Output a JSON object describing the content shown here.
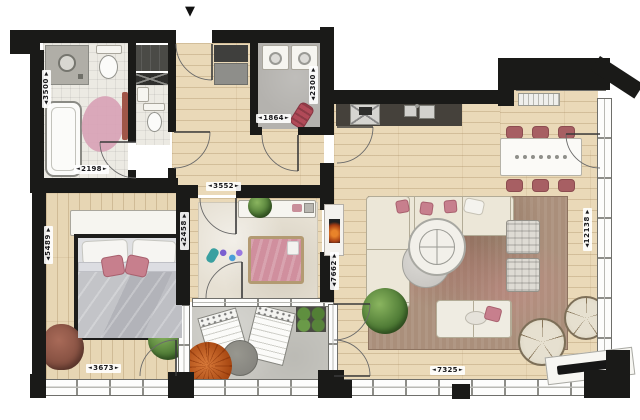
{
  "arrows": {
    "left": "◄",
    "right": "►",
    "up": "▲",
    "down": "▼",
    "entrance": "▼"
  },
  "dimensions": {
    "bathroom_height": "3500",
    "bathroom_width": "2198",
    "storage_width": "1864",
    "storage_height": "2300",
    "nursery_width": "3552",
    "nursery_height": "2458",
    "bedroom_height": "5489",
    "bedroom_width": "3673",
    "living_height": "7662",
    "living_width": "7325",
    "apartment_height": "12138"
  },
  "colors": {
    "wall": "#1a1a18",
    "wood_floor": "#ead9b8",
    "tile_floor": "#eceae3",
    "storage_floor": "#b4b2ae",
    "balcony_floor": "#c7c6c0",
    "living_rug": "#aa8f7b",
    "nursery_rug": "#e6e0d3",
    "accent_pink": "#c77f8d",
    "dining_chair_red": "#a75f63",
    "plant_green": "#477330",
    "plant_orange": "#c05a28",
    "counter_dark": "#45413b"
  }
}
